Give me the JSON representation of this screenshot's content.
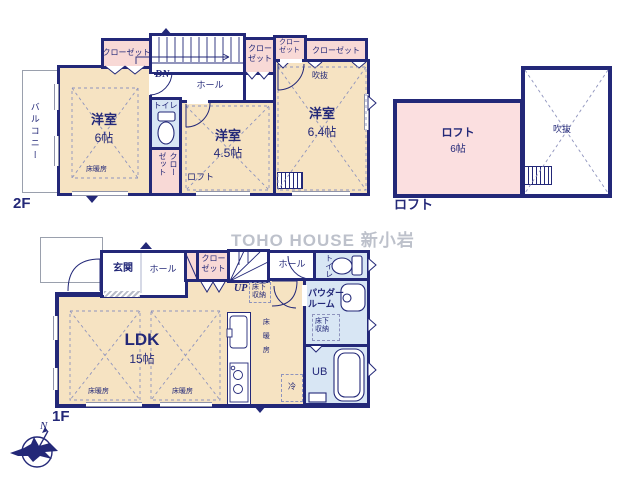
{
  "watermark": "TOHO HOUSE 新小岩",
  "colors": {
    "wall_navy": "#232878",
    "room_cream": "#f6e3c2",
    "closet_pink": "#f8d9d6",
    "wet_area_blue": "#d8e6f4",
    "loft_pink": "#fbdfe0",
    "dash_line": "#8e93bd",
    "watermark_gray": "#b2b7c2"
  },
  "floor2": {
    "floor_label": "2F",
    "balcony": "バルコニー",
    "closet_top_left": "クローゼット",
    "closet_mid_1": "クローゼット",
    "closet_mid_2": "クローゼット",
    "closet_top_right": "クローゼット",
    "closet_vertical": "クローゼット",
    "stairs_down": "DN",
    "hall": "ホール",
    "void_label": "吹抜",
    "room_6": {
      "name": "洋室",
      "size": "6帖",
      "heating": "床暖房"
    },
    "toilet": "トイレ",
    "loft_hatch": "ロフト",
    "room_45": {
      "name": "洋室",
      "size": "4.5帖"
    },
    "room_64": {
      "name": "洋室",
      "size": "6.4帖"
    }
  },
  "loft": {
    "floor_label": "ロフト",
    "room": {
      "name": "ロフト",
      "size": "6帖"
    },
    "void_label": "吹抜"
  },
  "floor1": {
    "floor_label": "1F",
    "entrance": "玄関",
    "hall_front": "ホール",
    "closet": "クローゼット",
    "stairs_up": "UP",
    "underfloor_storage_1": "床下収納",
    "hall_back": "ホール",
    "toilet": "トイレ",
    "powder_room": "パウダールーム",
    "underfloor_storage_2": "床下収納",
    "unit_bath": "UB",
    "ldk": {
      "name": "LDK",
      "size": "15帖"
    },
    "heating_left": "床暖房",
    "heating_right": "床暖房",
    "heating_kitchen": "床暖房",
    "fridge": "冷"
  },
  "compass": {
    "north": "N"
  }
}
